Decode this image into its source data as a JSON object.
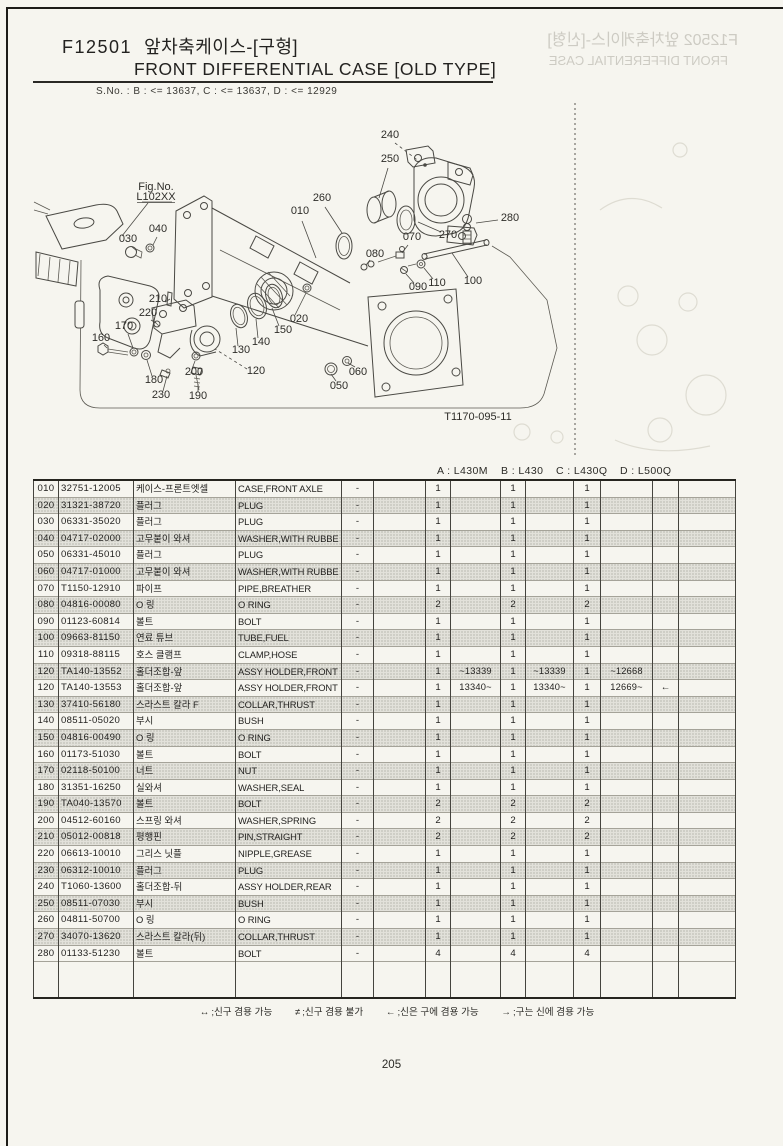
{
  "header": {
    "code": "F12501",
    "title_kr": "앞차축케이스-[구형]",
    "title_en": "FRONT DIFFERENTIAL CASE [OLD TYPE]",
    "serial_note": "S.No. :   B : <= 13637,   C : <= 13637,   D : <= 12929",
    "ghost_line1": "F12502 앞차축케이스-[신형]",
    "ghost_line2": "FRONT DIFFERENTIAL CASE"
  },
  "diagram": {
    "fig_label": "Fig.No.",
    "fig_value": "L102XX",
    "drawing_no": "T1170-095-11",
    "labels": [
      {
        "t": "010",
        "x": 300,
        "y": 214,
        "l": [
          302,
          221,
          316,
          258
        ]
      },
      {
        "t": "020",
        "x": 299,
        "y": 322,
        "l": [
          295,
          315,
          306,
          293
        ]
      },
      {
        "t": "030",
        "x": 128,
        "y": 242,
        "l": [
          132,
          247,
          137,
          251
        ]
      },
      {
        "t": "040",
        "x": 158,
        "y": 232,
        "l": [
          157,
          237,
          153,
          245
        ]
      },
      {
        "t": "050",
        "x": 339,
        "y": 389,
        "l": [
          336,
          381,
          331,
          374
        ]
      },
      {
        "t": "060",
        "x": 358,
        "y": 375,
        "l": [
          355,
          367,
          348,
          363
        ]
      },
      {
        "t": "070",
        "x": 412,
        "y": 240,
        "l": [
          408,
          245,
          402,
          253
        ]
      },
      {
        "t": "080",
        "x": 375,
        "y": 257,
        "l": [
          370,
          260,
          366,
          265
        ]
      },
      {
        "t": "090",
        "x": 418,
        "y": 290,
        "l": [
          414,
          283,
          406,
          274
        ]
      },
      {
        "t": "100",
        "x": 473,
        "y": 284,
        "l": [
          468,
          277,
          452,
          253
        ]
      },
      {
        "t": "110",
        "x": 437,
        "y": 286,
        "l": [
          433,
          279,
          424,
          268
        ]
      },
      {
        "t": "120",
        "x": 256,
        "y": 374,
        "d": 1,
        "l": [
          247,
          369,
          215,
          349
        ]
      },
      {
        "t": "130",
        "x": 241,
        "y": 353,
        "l": [
          238,
          346,
          236,
          328
        ]
      },
      {
        "t": "140",
        "x": 261,
        "y": 345,
        "l": [
          258,
          338,
          256,
          319
        ]
      },
      {
        "t": "150",
        "x": 283,
        "y": 333,
        "l": [
          279,
          326,
          272,
          308
        ]
      },
      {
        "t": "160",
        "x": 101,
        "y": 341,
        "l": [
          104,
          345,
          107,
          348
        ]
      },
      {
        "t": "170",
        "x": 124,
        "y": 329,
        "l": [
          128,
          334,
          133,
          348
        ]
      },
      {
        "t": "180",
        "x": 154,
        "y": 383,
        "l": [
          152,
          376,
          147,
          360
        ]
      },
      {
        "t": "190",
        "x": 198,
        "y": 399,
        "l": [
          198,
          392,
          198,
          384
        ]
      },
      {
        "t": "200",
        "x": 194,
        "y": 375,
        "l": [
          192,
          369,
          195,
          361
        ]
      },
      {
        "t": "210",
        "x": 158,
        "y": 302,
        "l": [
          165,
          302,
          170,
          299
        ]
      },
      {
        "t": "220",
        "x": 148,
        "y": 316,
        "l": [
          151,
          320,
          156,
          323
        ]
      },
      {
        "t": "230",
        "x": 161,
        "y": 398,
        "l": [
          163,
          391,
          167,
          376
        ]
      },
      {
        "t": "240",
        "x": 390,
        "y": 138,
        "d": 1,
        "l": [
          395,
          143,
          420,
          162
        ]
      },
      {
        "t": "250",
        "x": 390,
        "y": 162,
        "l": [
          388,
          168,
          379,
          198
        ]
      },
      {
        "t": "260",
        "x": 322,
        "y": 201,
        "l": [
          325,
          207,
          342,
          233
        ]
      },
      {
        "t": "270",
        "x": 448,
        "y": 238,
        "l": [
          441,
          232,
          418,
          222
        ]
      },
      {
        "t": "280",
        "x": 510,
        "y": 221,
        "l": [
          498,
          220,
          476,
          223
        ]
      },
      {
        "t": "Fig.No.",
        "x": 156,
        "y": 190,
        "s": 8
      },
      {
        "t": "L102XX",
        "x": 156,
        "y": 200,
        "s": 8,
        "u": 1
      },
      {
        "t": "T1170-095-11",
        "x": 478,
        "y": 420,
        "s": 6.5,
        "c": "#7a786e"
      }
    ]
  },
  "table": {
    "models": [
      "A : L430M",
      "B : L430",
      "C : L430Q",
      "D : L500Q"
    ],
    "rows": [
      {
        "ref": "010",
        "part": "32751-12005",
        "kr": "케이스-프론트엣셀",
        "en": "CASE,FRONT AXLE",
        "sym": "-",
        "cells": [
          "1",
          "",
          "1",
          "",
          "1",
          "",
          "",
          ""
        ]
      },
      {
        "ref": "020",
        "part": "31321-38720",
        "kr": "플러그",
        "en": "PLUG",
        "sym": "-",
        "cells": [
          "1",
          "",
          "1",
          "",
          "1",
          "",
          "",
          ""
        ]
      },
      {
        "ref": "030",
        "part": "06331-35020",
        "kr": "플러그",
        "en": "PLUG",
        "sym": "-",
        "cells": [
          "1",
          "",
          "1",
          "",
          "1",
          "",
          "",
          ""
        ]
      },
      {
        "ref": "040",
        "part": "04717-02000",
        "kr": "고무붙이 와셔",
        "en": "WASHER,WITH RUBBE",
        "sym": "-",
        "cells": [
          "1",
          "",
          "1",
          "",
          "1",
          "",
          "",
          ""
        ]
      },
      {
        "ref": "050",
        "part": "06331-45010",
        "kr": "플러그",
        "en": "PLUG",
        "sym": "-",
        "cells": [
          "1",
          "",
          "1",
          "",
          "1",
          "",
          "",
          ""
        ]
      },
      {
        "ref": "060",
        "part": "04717-01000",
        "kr": "고무붙이 와셔",
        "en": "WASHER,WITH RUBBE",
        "sym": "-",
        "cells": [
          "1",
          "",
          "1",
          "",
          "1",
          "",
          "",
          ""
        ]
      },
      {
        "ref": "070",
        "part": "T1150-12910",
        "kr": "파이프",
        "en": "PIPE,BREATHER",
        "sym": "-",
        "cells": [
          "1",
          "",
          "1",
          "",
          "1",
          "",
          "",
          ""
        ]
      },
      {
        "ref": "080",
        "part": "04816-00080",
        "kr": "O 링",
        "en": "O RING",
        "sym": "-",
        "cells": [
          "2",
          "",
          "2",
          "",
          "2",
          "",
          "",
          ""
        ]
      },
      {
        "ref": "090",
        "part": "01123-60814",
        "kr": "볼트",
        "en": "BOLT",
        "sym": "-",
        "cells": [
          "1",
          "",
          "1",
          "",
          "1",
          "",
          "",
          ""
        ]
      },
      {
        "ref": "100",
        "part": "09663-81150",
        "kr": "연료 튜브",
        "en": "TUBE,FUEL",
        "sym": "-",
        "cells": [
          "1",
          "",
          "1",
          "",
          "1",
          "",
          "",
          ""
        ]
      },
      {
        "ref": "110",
        "part": "09318-88115",
        "kr": "호스 클램프",
        "en": "CLAMP,HOSE",
        "sym": "-",
        "cells": [
          "1",
          "",
          "1",
          "",
          "1",
          "",
          "",
          ""
        ]
      },
      {
        "ref": "120",
        "part": "TA140-13552",
        "kr": "홀더조합-앞",
        "en": "ASSY HOLDER,FRONT",
        "sym": "-",
        "cells": [
          "1",
          "~13339",
          "1",
          "~13339",
          "1",
          "~12668",
          "",
          ""
        ]
      },
      {
        "ref": "120",
        "part": "TA140-13553",
        "kr": "홀더조합-앞",
        "en": "ASSY HOLDER,FRONT",
        "sym": "-",
        "cells": [
          "1",
          "13340~",
          "1",
          "13340~",
          "1",
          "12669~",
          "←",
          ""
        ]
      },
      {
        "ref": "130",
        "part": "37410-56180",
        "kr": "스라스트 칼라 F",
        "en": "COLLAR,THRUST",
        "sym": "-",
        "cells": [
          "1",
          "",
          "1",
          "",
          "1",
          "",
          "",
          ""
        ]
      },
      {
        "ref": "140",
        "part": "08511-05020",
        "kr": "부시",
        "en": "BUSH",
        "sym": "-",
        "cells": [
          "1",
          "",
          "1",
          "",
          "1",
          "",
          "",
          ""
        ]
      },
      {
        "ref": "150",
        "part": "04816-00490",
        "kr": "O 링",
        "en": "O RING",
        "sym": "-",
        "cells": [
          "1",
          "",
          "1",
          "",
          "1",
          "",
          "",
          ""
        ]
      },
      {
        "ref": "160",
        "part": "01173-51030",
        "kr": "볼트",
        "en": "BOLT",
        "sym": "-",
        "cells": [
          "1",
          "",
          "1",
          "",
          "1",
          "",
          "",
          ""
        ]
      },
      {
        "ref": "170",
        "part": "02118-50100",
        "kr": "너트",
        "en": "NUT",
        "sym": "-",
        "cells": [
          "1",
          "",
          "1",
          "",
          "1",
          "",
          "",
          ""
        ]
      },
      {
        "ref": "180",
        "part": "31351-16250",
        "kr": "실와셔",
        "en": "WASHER,SEAL",
        "sym": "-",
        "cells": [
          "1",
          "",
          "1",
          "",
          "1",
          "",
          "",
          ""
        ]
      },
      {
        "ref": "190",
        "part": "TA040-13570",
        "kr": "볼트",
        "en": "BOLT",
        "sym": "-",
        "cells": [
          "2",
          "",
          "2",
          "",
          "2",
          "",
          "",
          ""
        ]
      },
      {
        "ref": "200",
        "part": "04512-60160",
        "kr": "스프링 와셔",
        "en": "WASHER,SPRING",
        "sym": "-",
        "cells": [
          "2",
          "",
          "2",
          "",
          "2",
          "",
          "",
          ""
        ]
      },
      {
        "ref": "210",
        "part": "05012-00818",
        "kr": "평행핀",
        "en": "PIN,STRAIGHT",
        "sym": "-",
        "cells": [
          "2",
          "",
          "2",
          "",
          "2",
          "",
          "",
          ""
        ]
      },
      {
        "ref": "220",
        "part": "06613-10010",
        "kr": "그리스 닛플",
        "en": "NIPPLE,GREASE",
        "sym": "-",
        "cells": [
          "1",
          "",
          "1",
          "",
          "1",
          "",
          "",
          ""
        ]
      },
      {
        "ref": "230",
        "part": "06312-10010",
        "kr": "플러그",
        "en": "PLUG",
        "sym": "-",
        "cells": [
          "1",
          "",
          "1",
          "",
          "1",
          "",
          "",
          ""
        ]
      },
      {
        "ref": "240",
        "part": "T1060-13600",
        "kr": "홀더조합-뒤",
        "en": "ASSY HOLDER,REAR",
        "sym": "-",
        "cells": [
          "1",
          "",
          "1",
          "",
          "1",
          "",
          "",
          ""
        ]
      },
      {
        "ref": "250",
        "part": "08511-07030",
        "kr": "부시",
        "en": "BUSH",
        "sym": "-",
        "cells": [
          "1",
          "",
          "1",
          "",
          "1",
          "",
          "",
          ""
        ]
      },
      {
        "ref": "260",
        "part": "04811-50700",
        "kr": "O 링",
        "en": "O RING",
        "sym": "-",
        "cells": [
          "1",
          "",
          "1",
          "",
          "1",
          "",
          "",
          ""
        ]
      },
      {
        "ref": "270",
        "part": "34070-13620",
        "kr": "스라스트 칼라(뒤)",
        "en": "COLLAR,THRUST",
        "sym": "-",
        "cells": [
          "1",
          "",
          "1",
          "",
          "1",
          "",
          "",
          ""
        ]
      },
      {
        "ref": "280",
        "part": "01133-51230",
        "kr": "볼트",
        "en": "BOLT",
        "sym": "-",
        "cells": [
          "4",
          "",
          "4",
          "",
          "4",
          "",
          "",
          ""
        ]
      }
    ]
  },
  "legend": {
    "items": [
      {
        "sym": "↔",
        "text": ";신구 겸용 가능"
      },
      {
        "sym": "≠",
        "text": ";신구 겸용 불가"
      },
      {
        "sym": "←",
        "text": ";신은 구에 겸용 가능"
      },
      {
        "sym": "→",
        "text": ";구는 신에 겸용 가능"
      }
    ]
  },
  "footer": {
    "page_number": "205"
  }
}
